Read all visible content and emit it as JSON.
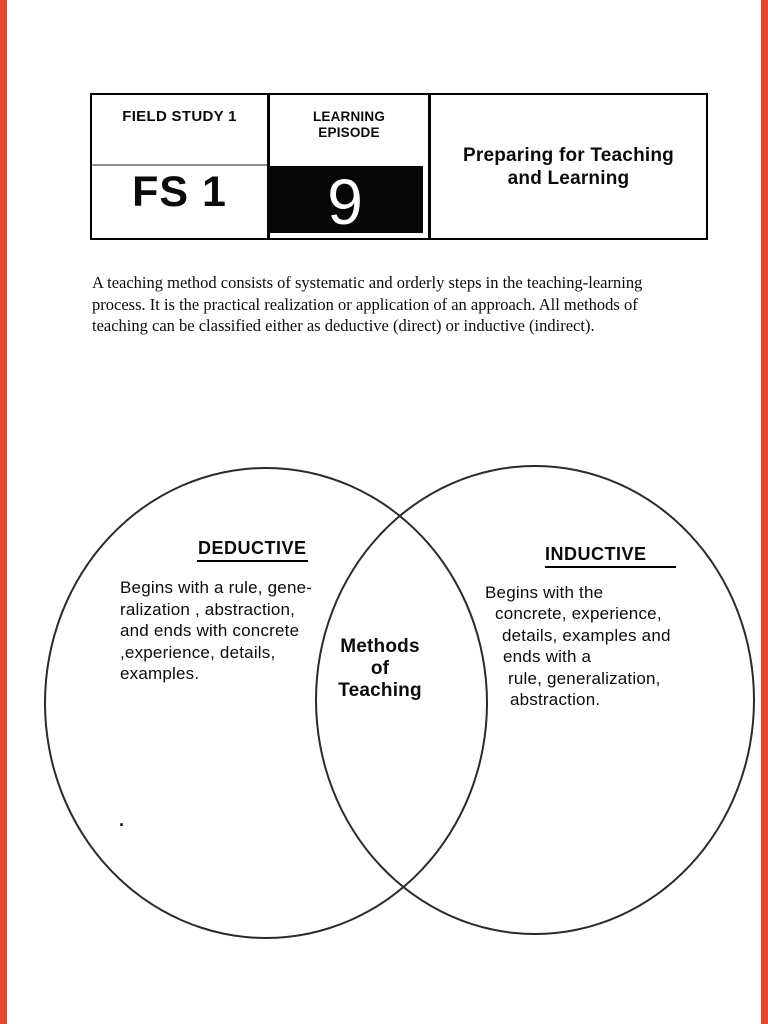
{
  "page": {
    "background": "#ffffff",
    "edge_strip_color": "#e6492f"
  },
  "header_table": {
    "course_label": "FIELD STUDY 1",
    "course_code": "FS 1",
    "episode_label_line1": "LEARNING",
    "episode_label_line2": "EPISODE",
    "episode_number": "9",
    "title_line1": "Preparing for Teaching",
    "title_line2": "and Learning"
  },
  "intro": {
    "lines": [
      "A teaching method consists of systematic and orderly steps in the teaching-learning",
      "process. It is the practical realization or application of an approach. All methods of",
      "teaching can be classified either as deductive (direct) or inductive (indirect)."
    ]
  },
  "venn": {
    "left": {
      "title": "DEDUCTIVE",
      "lines": [
        "Begins with a rule, gene-",
        "ralization , abstraction,",
        "and ends with concrete",
        ",experience, details,",
        "examples."
      ]
    },
    "right": {
      "title": "INDUCTIVE",
      "lines": [
        "Begins with the",
        "concrete, experience,",
        "details, examples and",
        "ends with a",
        "rule, generalization,",
        "abstraction."
      ]
    },
    "center": {
      "lines": [
        "Methods",
        "of",
        "Teaching"
      ]
    },
    "stray_mark": "."
  }
}
